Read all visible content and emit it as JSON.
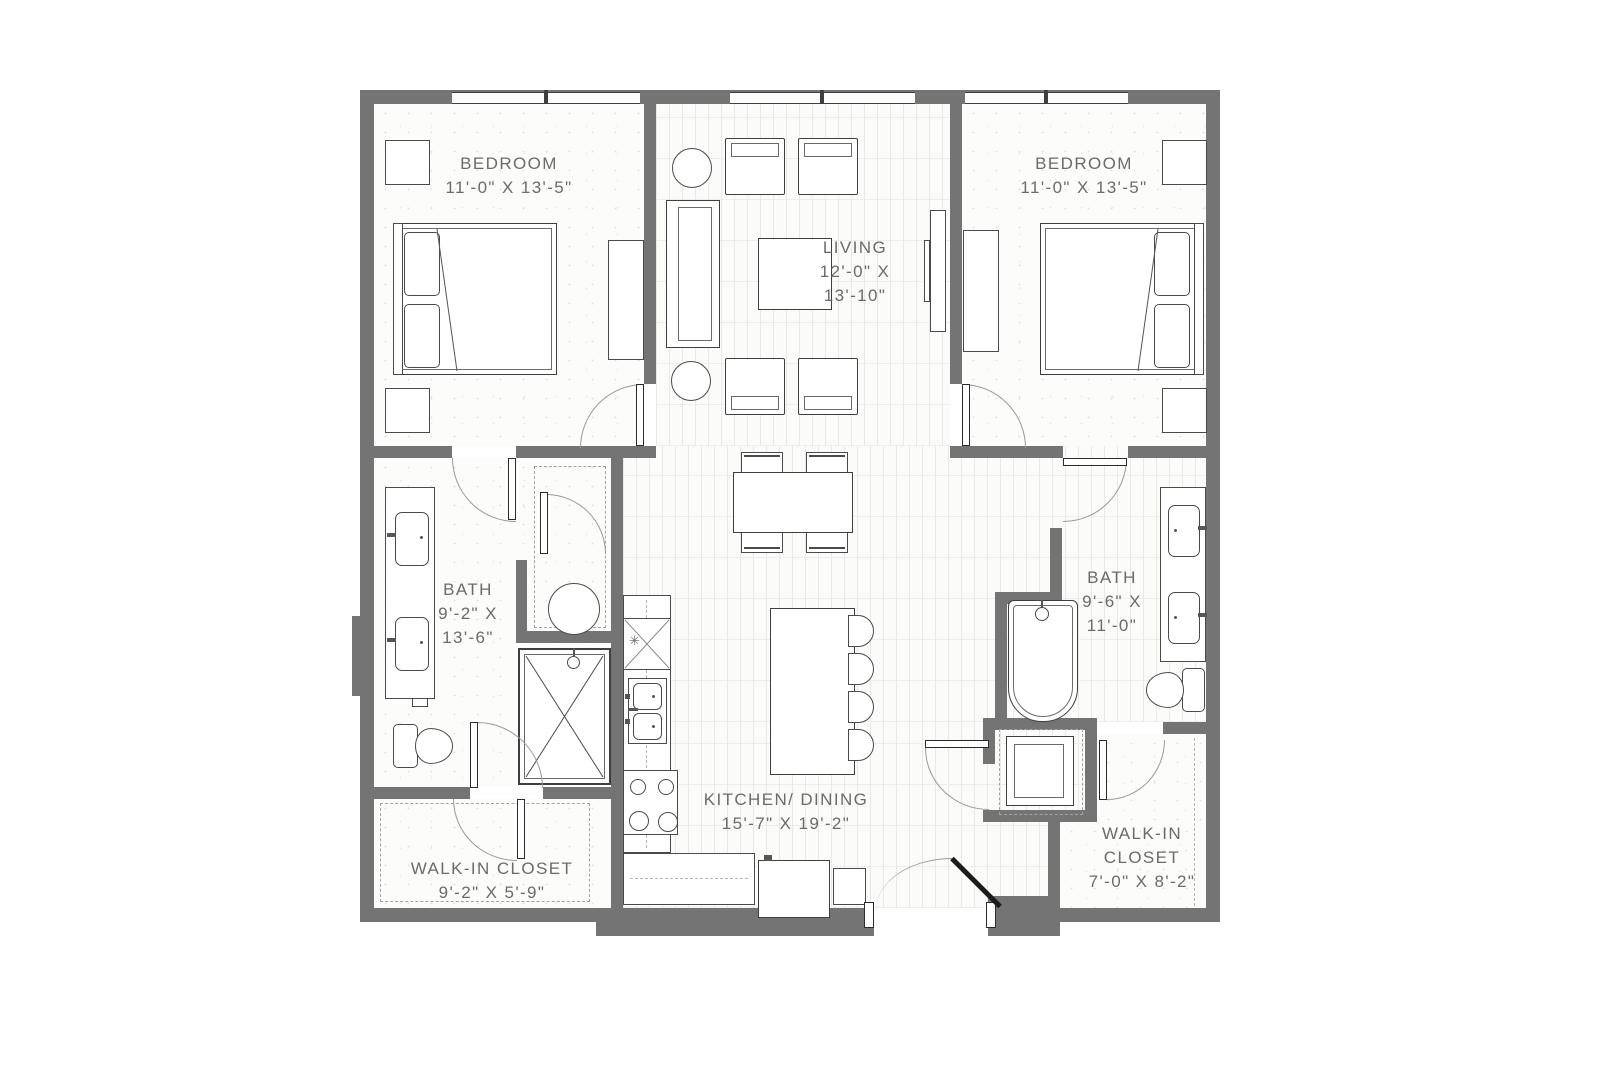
{
  "page": {
    "background": "#ffffff"
  },
  "colors": {
    "wall": "#747474",
    "outline": "#3f3f3f",
    "furniture_line": "#4a4a4a",
    "door_arc": "#9a9a9a",
    "label_text": "#6b6b6b",
    "plank_line": "#e9e9e5",
    "speckle_dot": "#e2e2de"
  },
  "rooms": {
    "bedroom_left": {
      "lines": [
        "BEDROOM",
        "11'-0\" X 13'-5\""
      ]
    },
    "living": {
      "lines": [
        "LIVING",
        "12'-0\" X",
        "13'-10\""
      ]
    },
    "bedroom_right": {
      "lines": [
        "BEDROOM",
        "11'-0\" X 13'-5\""
      ]
    },
    "bath_left": {
      "lines": [
        "BATH",
        "9'-2\" X",
        "13'-6\""
      ]
    },
    "bath_right": {
      "lines": [
        "BATH",
        "9'-6\" X",
        "11'-0\""
      ]
    },
    "kitchen_dining": {
      "lines": [
        "KITCHEN/ DINING",
        "15'-7\" X 19'-2\""
      ]
    },
    "walk_in_closet_left": {
      "lines": [
        "WALK-IN CLOSET",
        "9'-2\" X 5'-9\""
      ]
    },
    "walk_in_closet_right": {
      "lines": [
        "WALK-IN",
        "CLOSET",
        "7'-0\" X 8'-2\""
      ]
    }
  },
  "kitchen": {
    "counter_mark": "✳"
  }
}
